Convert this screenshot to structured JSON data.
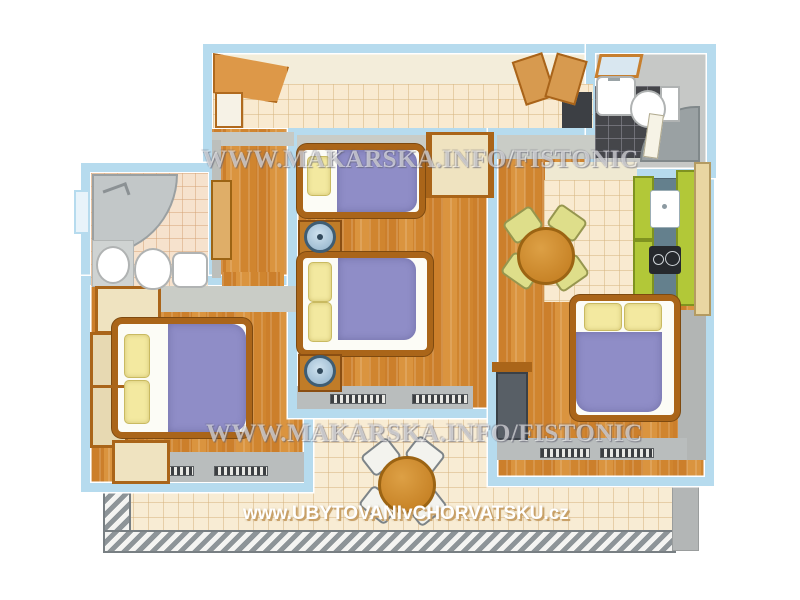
{
  "watermarks": {
    "top": "WWW.MAKARSKA.INFO/FISTONIC",
    "middle": "WWW.MAKARSKA.INFO/FISTONIC",
    "bottom": "www.UBYTOVANIvCHORVATSKU.cz"
  },
  "palette": {
    "wall_blue": "#b6dbee",
    "wood_floor": "#d28a36",
    "wood_trim": "#aa6519",
    "tile_cream": "#f9ead0",
    "bathroom_tile_dark": "#45464a",
    "bathroom_tile_light": "#f6e2cd",
    "bed_cover_purple": "#8f8dc7",
    "pillow_yellow": "#f3e9a0",
    "kitchen_cabinet_green": "#b2c838",
    "kitchen_counter_slate": "#64808d",
    "cabinet_cream": "#efe3c0",
    "railing_gray": "#8d9498",
    "lamp_blue": "#8fb0c9",
    "table_wood": "#c0791c"
  },
  "inventory": {
    "double_beds": 3,
    "single_beds": 1,
    "bathrooms": 2,
    "round_tables": 2,
    "dining_chairs": 4,
    "terrace_chairs": 4,
    "nightstand_lamps": 2,
    "kitchen_units": 1,
    "terrace": 1
  }
}
